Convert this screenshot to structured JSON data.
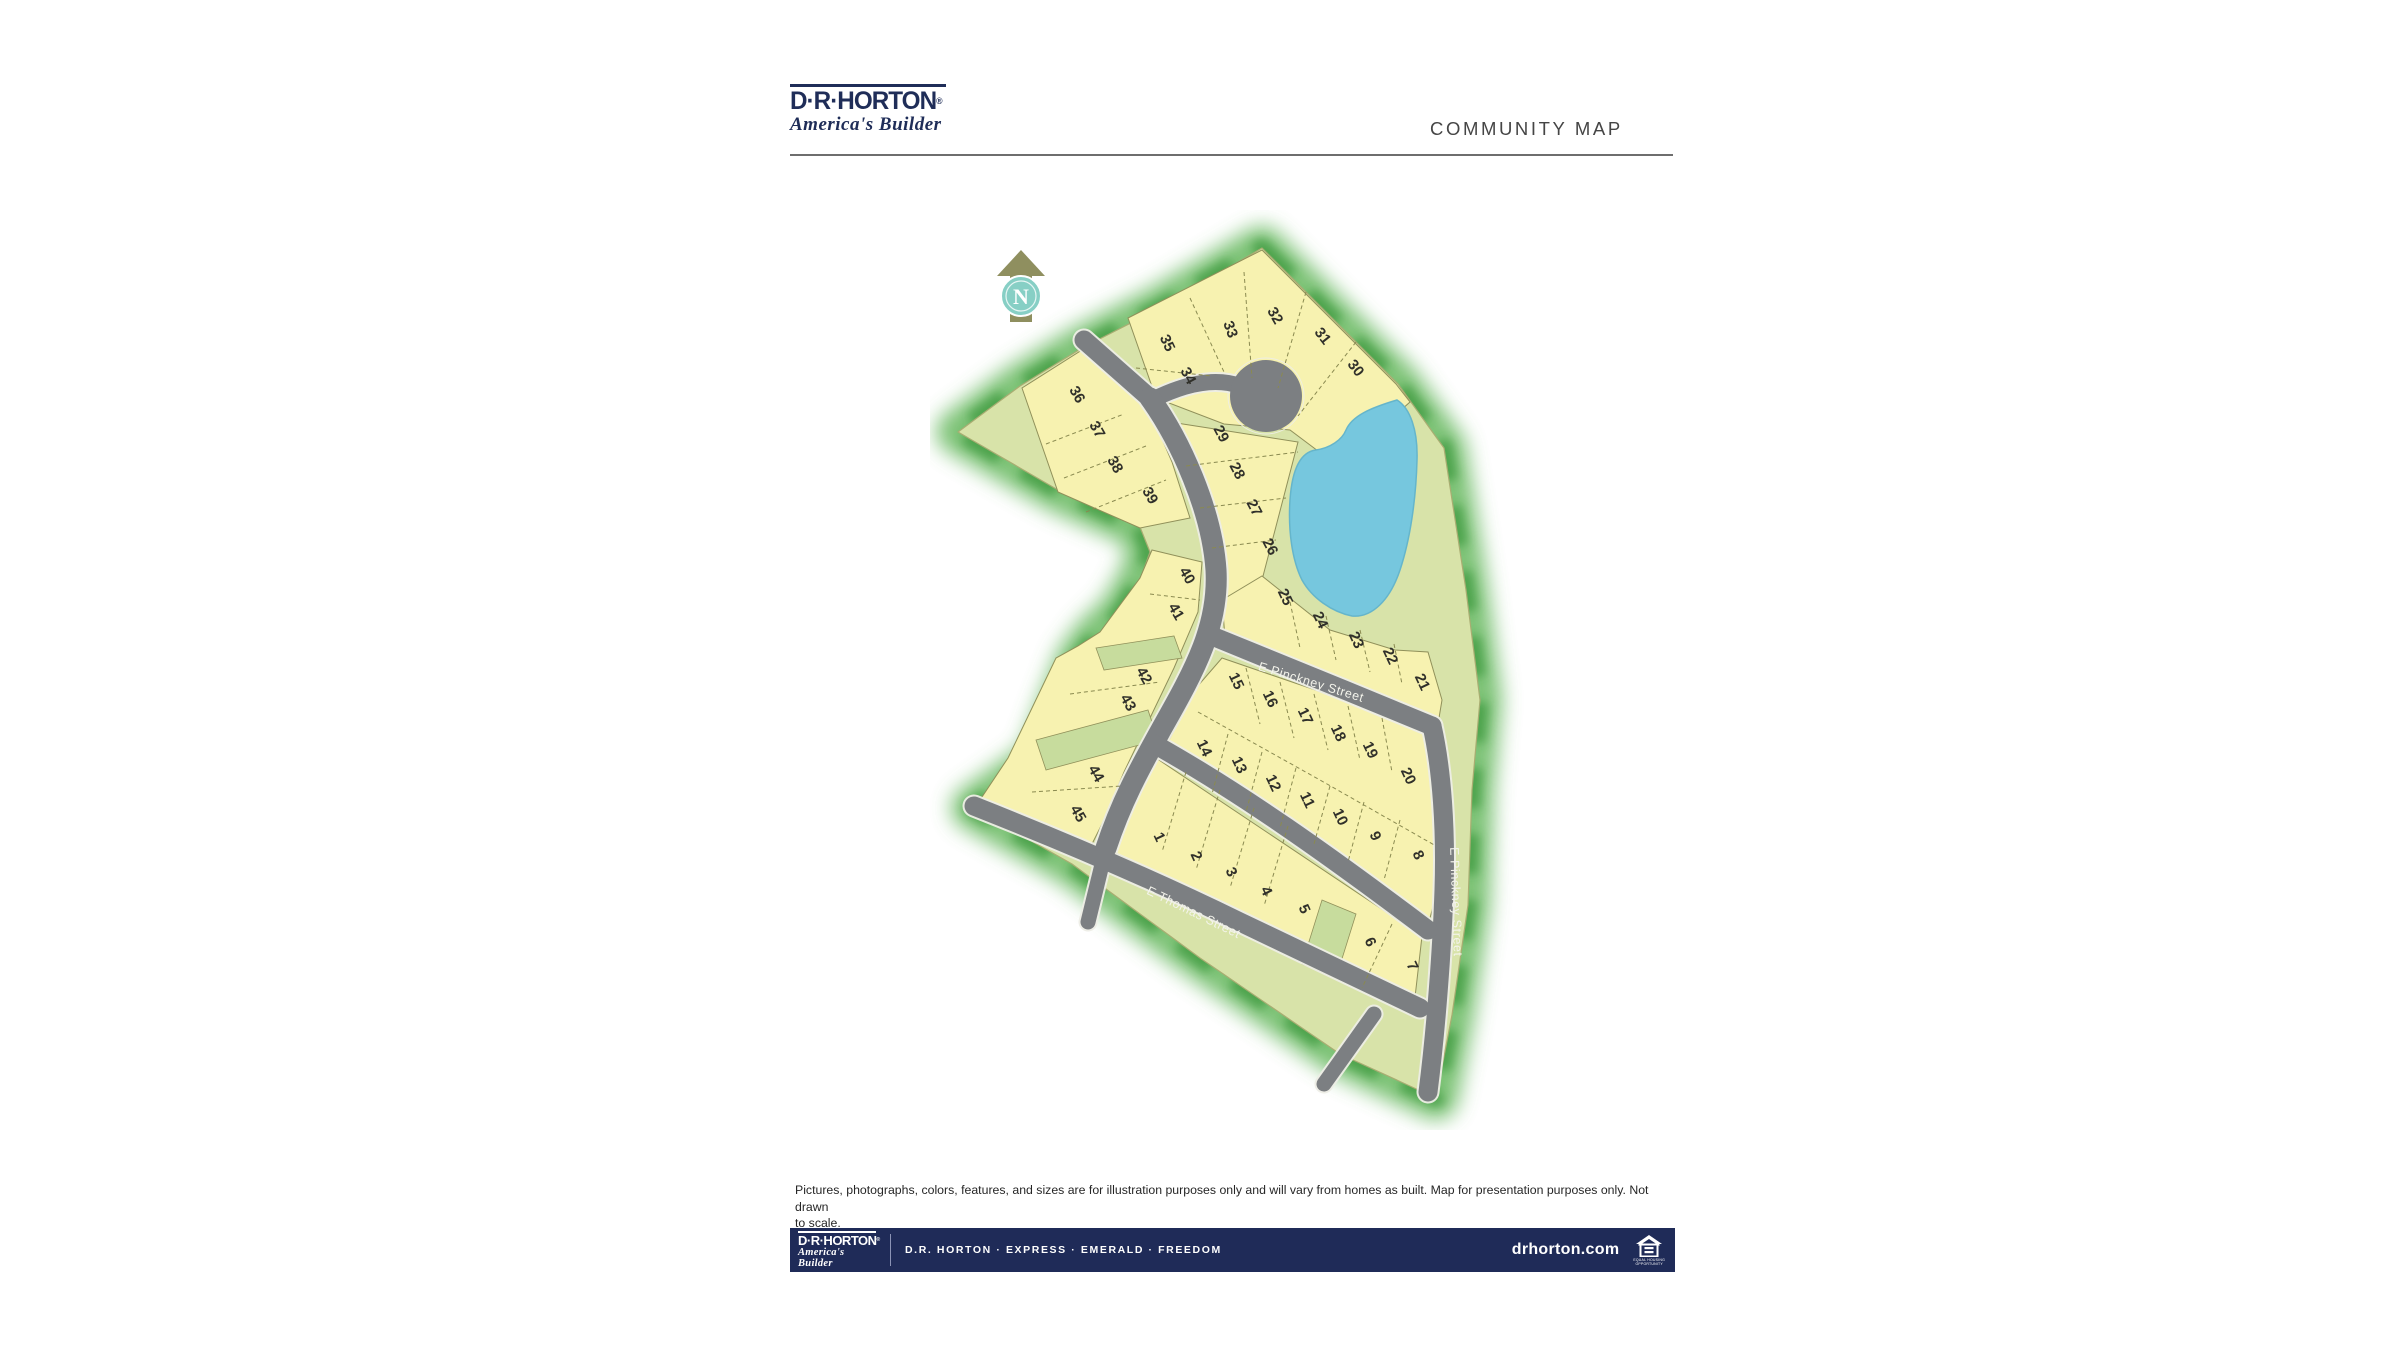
{
  "header": {
    "logo_name": "D·R·HORTON",
    "logo_reg": "®",
    "logo_tagline": "America's Builder",
    "title": "COMMUNITY MAP"
  },
  "colors": {
    "brand_navy": "#1f2b58",
    "lot_yellow": "#f7f2b0",
    "common_green": "#d8e3a9",
    "green_lot": "#c7dc9d",
    "pond_blue": "#76c7de",
    "street_gray": "#7c7f82",
    "tree_green": "#4ca348"
  },
  "map": {
    "north_label": "N",
    "street_labels": [
      {
        "label": "E Pinckney Street",
        "x": 1310,
        "y": 686,
        "rot": 17
      },
      {
        "label": "E Pinckney Street",
        "x": 1452,
        "y": 902,
        "rot": 88
      },
      {
        "label": "E Thomas Street",
        "x": 1192,
        "y": 916,
        "rot": 26
      }
    ],
    "lots": [
      {
        "n": "1",
        "x": 1155,
        "y": 839,
        "rot": 65
      },
      {
        "n": "2",
        "x": 1192,
        "y": 858,
        "rot": 65
      },
      {
        "n": "3",
        "x": 1227,
        "y": 874,
        "rot": 65
      },
      {
        "n": "4",
        "x": 1262,
        "y": 893,
        "rot": 65
      },
      {
        "n": "5",
        "x": 1300,
        "y": 911,
        "rot": 65
      },
      {
        "n": "6",
        "x": 1366,
        "y": 944,
        "rot": 65
      },
      {
        "n": "7",
        "x": 1408,
        "y": 968,
        "rot": 65
      },
      {
        "n": "8",
        "x": 1414,
        "y": 857,
        "rot": 65
      },
      {
        "n": "9",
        "x": 1371,
        "y": 838,
        "rot": 65
      },
      {
        "n": "10",
        "x": 1336,
        "y": 819,
        "rot": 65
      },
      {
        "n": "11",
        "x": 1303,
        "y": 802,
        "rot": 65
      },
      {
        "n": "12",
        "x": 1269,
        "y": 785,
        "rot": 65
      },
      {
        "n": "13",
        "x": 1235,
        "y": 767,
        "rot": 65
      },
      {
        "n": "14",
        "x": 1200,
        "y": 750,
        "rot": 65
      },
      {
        "n": "15",
        "x": 1232,
        "y": 683,
        "rot": 65
      },
      {
        "n": "16",
        "x": 1266,
        "y": 701,
        "rot": 65
      },
      {
        "n": "17",
        "x": 1301,
        "y": 718,
        "rot": 65
      },
      {
        "n": "18",
        "x": 1334,
        "y": 735,
        "rot": 65
      },
      {
        "n": "19",
        "x": 1366,
        "y": 752,
        "rot": 65
      },
      {
        "n": "20",
        "x": 1404,
        "y": 778,
        "rot": 65
      },
      {
        "n": "21",
        "x": 1418,
        "y": 684,
        "rot": 65
      },
      {
        "n": "22",
        "x": 1386,
        "y": 658,
        "rot": 65
      },
      {
        "n": "23",
        "x": 1352,
        "y": 642,
        "rot": 65
      },
      {
        "n": "24",
        "x": 1316,
        "y": 622,
        "rot": 65
      },
      {
        "n": "25",
        "x": 1281,
        "y": 599,
        "rot": 65
      },
      {
        "n": "26",
        "x": 1266,
        "y": 549,
        "rot": 62
      },
      {
        "n": "27",
        "x": 1250,
        "y": 510,
        "rot": 62
      },
      {
        "n": "28",
        "x": 1233,
        "y": 473,
        "rot": 62
      },
      {
        "n": "29",
        "x": 1217,
        "y": 436,
        "rot": 62
      },
      {
        "n": "30",
        "x": 1352,
        "y": 371,
        "rot": 52
      },
      {
        "n": "31",
        "x": 1319,
        "y": 339,
        "rot": 52
      },
      {
        "n": "32",
        "x": 1271,
        "y": 318,
        "rot": 60
      },
      {
        "n": "33",
        "x": 1226,
        "y": 331,
        "rot": 70
      },
      {
        "n": "34",
        "x": 1184,
        "y": 378,
        "rot": 62
      },
      {
        "n": "35",
        "x": 1163,
        "y": 345,
        "rot": 65
      },
      {
        "n": "36",
        "x": 1073,
        "y": 397,
        "rot": 60
      },
      {
        "n": "37",
        "x": 1093,
        "y": 432,
        "rot": 60
      },
      {
        "n": "38",
        "x": 1111,
        "y": 467,
        "rot": 60
      },
      {
        "n": "39",
        "x": 1146,
        "y": 498,
        "rot": 60
      },
      {
        "n": "40",
        "x": 1183,
        "y": 578,
        "rot": 60
      },
      {
        "n": "41",
        "x": 1172,
        "y": 614,
        "rot": 60
      },
      {
        "n": "42",
        "x": 1140,
        "y": 678,
        "rot": 60
      },
      {
        "n": "43",
        "x": 1124,
        "y": 705,
        "rot": 60
      },
      {
        "n": "44",
        "x": 1092,
        "y": 776,
        "rot": 60
      },
      {
        "n": "45",
        "x": 1074,
        "y": 816,
        "rot": 60
      }
    ]
  },
  "disclaimer": {
    "line1": "Pictures, photographs, colors, features, and sizes are for illustration purposes only and will vary from homes as built. Map for presentation purposes only. Not drawn",
    "line2": "to scale."
  },
  "footer": {
    "logo_name": "D·R·HORTON",
    "logo_reg": "®",
    "logo_tagline": "America's Builder",
    "brands": "D.R. HORTON  ·  EXPRESS  ·  EMERALD  ·  FREEDOM",
    "website": "drhorton.com",
    "eho_line1": "EQUAL HOUSING",
    "eho_line2": "OPPORTUNITY"
  }
}
